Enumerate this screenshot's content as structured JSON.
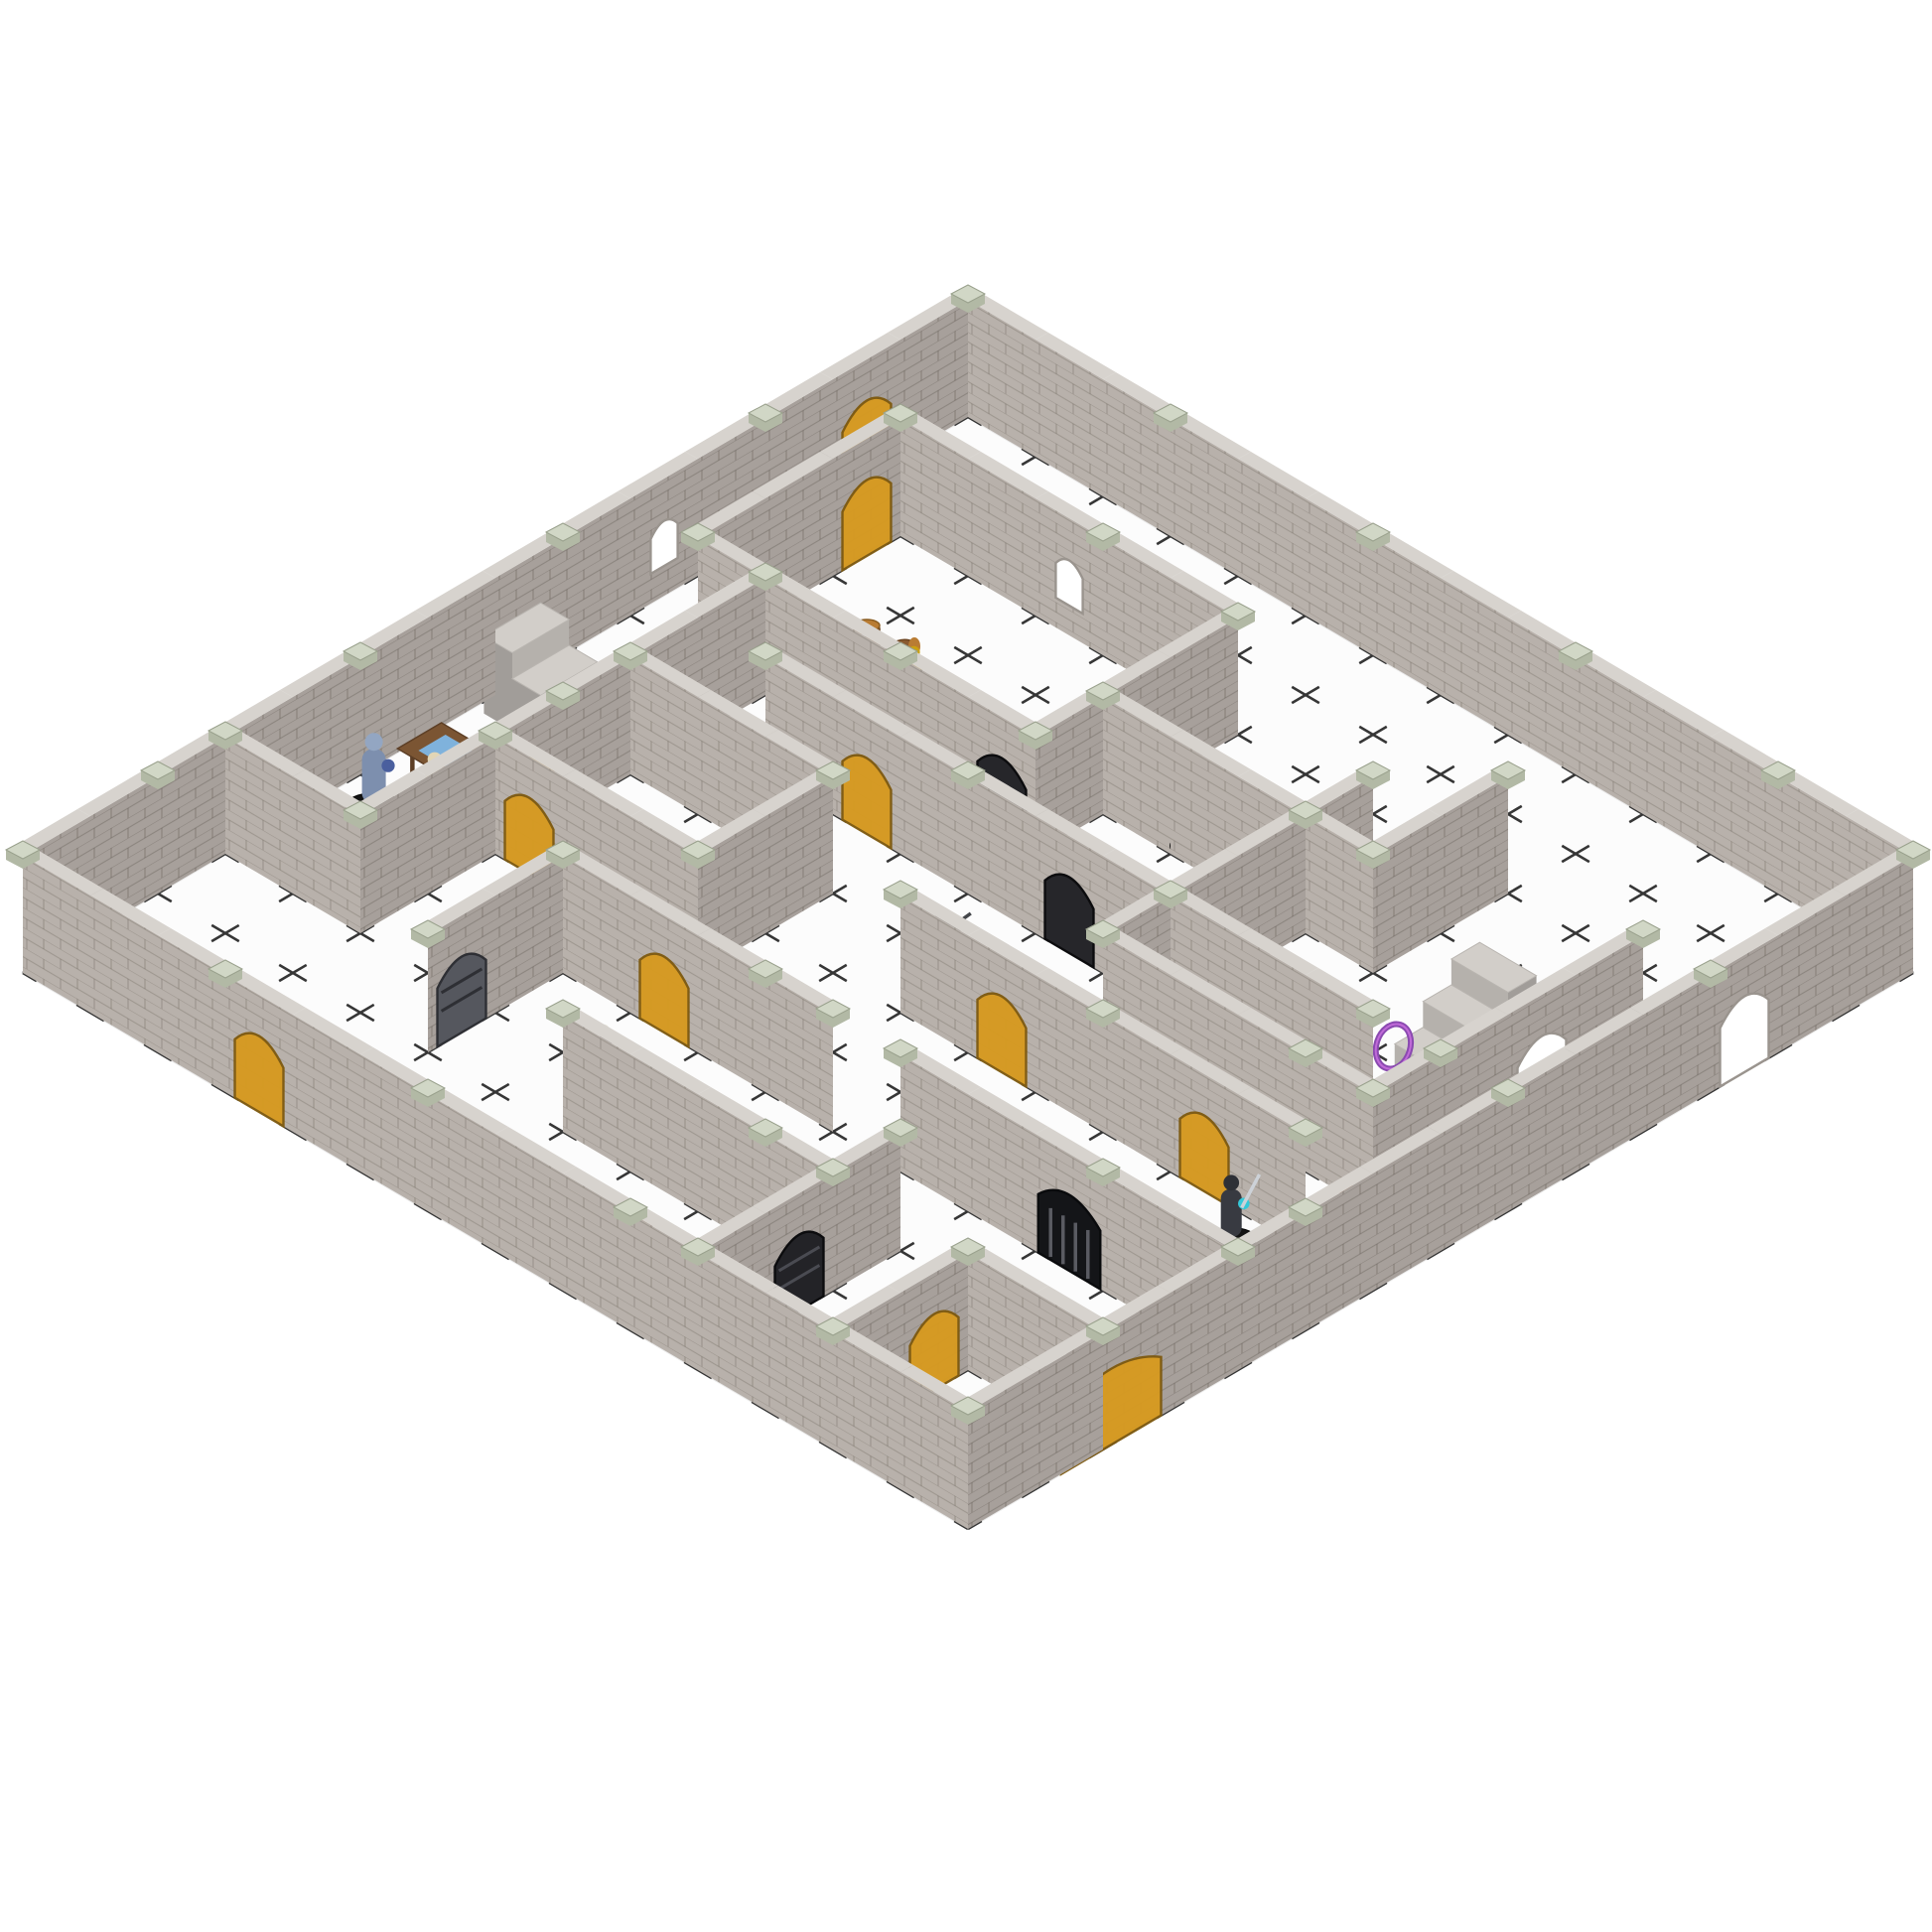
{
  "scene": {
    "type": "product-photo",
    "subject": "Modular snap-together plastic dungeon terrain set (gray brick wall panels with sage-green connector clips) assembled as a multi-room maze on a white dry-erase grid mat, populated with painted fantasy RPG miniatures, translucent amber doors, black iron doors, portcullis gates, staircases, barrels, tables and treasure",
    "background_color": "#ffffff"
  },
  "palette": {
    "background": "#ffffff",
    "floor": "#fcfcfc",
    "floor_edge": "#ececec",
    "grid": "#1b1b1b",
    "wall_sw": "#b8b1ab",
    "wall_se": "#a7a09b",
    "wall_top": "#d7d3ce",
    "mortar": "#5f584e",
    "cap_top": "#d1d7c6",
    "cap_side": "#b2b9a5",
    "door_amber": "#d79a20",
    "door_amber_edge": "#7e5a10",
    "door_black": "#26262a",
    "door_gray": "#55575e",
    "door_smoke": "#3c3c40",
    "gate": "#141518",
    "gate_bar": "#5a5b62",
    "opening": "#ffffff",
    "opening_edge": "#9a948e",
    "mini_base": "#141414",
    "stair_top": "#d2cec9",
    "stair_front": "#b5b1ac",
    "stair_side": "#a19d99",
    "wood": "#7b5533",
    "wood_dark": "#5d3f26",
    "map_blue": "#7fb2dc",
    "barrel": "#8a5a30",
    "barrel_lid": "#b97c33",
    "gold": "#d8a820",
    "gold_light": "#f0c840",
    "ring_purple": "#8a4ab0",
    "book_red": "#e2481a",
    "book_blue": "#7fa8d0"
  },
  "board": {
    "cols": 14,
    "rows": 14,
    "origin": [
      975,
      420
    ],
    "tileA": [
      68,
      40
    ],
    "tileB": [
      -68,
      40
    ],
    "wall_height": 118,
    "door_height": 84,
    "grid_dash": "16 46.9 16 0",
    "grid_stroke_width": 2.6
  },
  "walls": [
    {
      "i": 0,
      "j": 0,
      "dir": "A",
      "len": 14,
      "f": []
    },
    {
      "i": 0,
      "j": 0,
      "dir": "B",
      "len": 14,
      "f": [
        {
          "t": 1,
          "type": "amber"
        },
        {
          "t": 4,
          "type": "window"
        }
      ]
    },
    {
      "i": 0,
      "j": 14,
      "dir": "A",
      "len": 14,
      "f": [
        {
          "t": 3,
          "type": "amber"
        }
      ]
    },
    {
      "i": 14,
      "j": 0,
      "dir": "B",
      "len": 14,
      "f": [
        {
          "t": 2,
          "type": "arch"
        },
        {
          "t": 11,
          "type": "amber2"
        }
      ]
    },
    {
      "i": 1,
      "j": 2,
      "dir": "A",
      "len": 5,
      "f": [
        {
          "t": 2,
          "type": "window"
        }
      ]
    },
    {
      "i": 1,
      "j": 5,
      "dir": "A",
      "len": 5,
      "f": [
        {
          "t": 4,
          "type": "black"
        }
      ]
    },
    {
      "i": 1,
      "j": 2,
      "dir": "B",
      "len": 3,
      "f": [
        {
          "t": 0,
          "type": "amber"
        }
      ]
    },
    {
      "i": 6,
      "j": 2,
      "dir": "B",
      "len": 3,
      "f": []
    },
    {
      "i": 2,
      "j": 5,
      "dir": "B",
      "len": 6,
      "f": [
        {
          "t": 3,
          "type": "amber"
        }
      ]
    },
    {
      "i": 0,
      "j": 11,
      "dir": "A",
      "len": 2,
      "f": []
    },
    {
      "i": 2,
      "j": 7,
      "dir": "A",
      "len": 3,
      "f": []
    },
    {
      "i": 2,
      "j": 9,
      "dir": "A",
      "len": 3,
      "f": [
        {
          "t": 0,
          "type": "amber"
        }
      ]
    },
    {
      "i": 5,
      "j": 7,
      "dir": "B",
      "len": 2,
      "f": []
    },
    {
      "i": 3,
      "j": 6,
      "dir": "A",
      "len": 9,
      "f": [
        {
          "t": 1,
          "type": "amber"
        },
        {
          "t": 4,
          "type": "black"
        }
      ]
    },
    {
      "i": 6,
      "j": 4,
      "dir": "A",
      "len": 4,
      "f": []
    },
    {
      "i": 10,
      "j": 2,
      "dir": "B",
      "len": 2,
      "f": []
    },
    {
      "i": 9,
      "j": 3,
      "dir": "B",
      "len": 4,
      "f": [
        {
          "t": 2,
          "type": "smoke"
        }
      ]
    },
    {
      "i": 9,
      "j": 7,
      "dir": "A",
      "len": 4,
      "f": []
    },
    {
      "i": 13,
      "j": 3,
      "dir": "B",
      "len": 4,
      "f": [
        {
          "t": 1,
          "type": "arch"
        }
      ]
    },
    {
      "i": 7,
      "j": 8,
      "dir": "A",
      "len": 6,
      "f": [
        {
          "t": 1,
          "type": "amber"
        },
        {
          "t": 4,
          "type": "amber"
        }
      ]
    },
    {
      "i": 9,
      "j": 10,
      "dir": "A",
      "len": 5,
      "f": [
        {
          "t": 2,
          "type": "gate"
        }
      ]
    },
    {
      "i": 4,
      "j": 10,
      "dir": "A",
      "len": 4,
      "f": [
        {
          "t": 1,
          "type": "amber"
        }
      ]
    },
    {
      "i": 4,
      "j": 10,
      "dir": "B",
      "len": 2,
      "f": [
        {
          "t": 1,
          "type": "gray"
        }
      ]
    },
    {
      "i": 6,
      "j": 12,
      "dir": "A",
      "len": 4,
      "f": []
    },
    {
      "i": 10,
      "j": 11,
      "dir": "B",
      "len": 3,
      "f": [
        {
          "t": 1,
          "type": "blackbar"
        }
      ]
    },
    {
      "i": 12,
      "j": 12,
      "dir": "A",
      "len": 2,
      "f": [
        {
          "t": 1,
          "type": "arch"
        }
      ]
    },
    {
      "i": 12,
      "j": 12,
      "dir": "B",
      "len": 2,
      "f": [
        {
          "t": 0,
          "type": "amber"
        }
      ]
    }
  ],
  "props": [
    {
      "name": "staircase-left",
      "pos": [
        0.15,
        6.4
      ],
      "dir": "A"
    },
    {
      "name": "staircase-right",
      "pos": [
        11.3,
        3.8
      ],
      "dir": "B"
    },
    {
      "name": "map-table",
      "pos": [
        0.3,
        8.1
      ]
    },
    {
      "name": "barrels",
      "pos": [
        2.3,
        3.8
      ]
    },
    {
      "name": "round-table-books",
      "pos": [
        7.9,
        13.0
      ]
    },
    {
      "name": "treasure-pile",
      "pos": [
        10.6,
        5.9
      ]
    },
    {
      "name": "magic-ring",
      "pos": [
        11.35,
        5.05
      ]
    }
  ],
  "miniatures": [
    {
      "name": "frost-armored-warrior",
      "kind": "biped",
      "pos": [
        0.5,
        9.3
      ],
      "scale": 1.2,
      "body": "#7d8fae",
      "head": "#93a6c2",
      "accent": "#4a5f9e"
    },
    {
      "name": "skeleton",
      "kind": "biped",
      "pos": [
        1.0,
        8.9
      ],
      "scale": 0.95,
      "body": "#d7c9a4",
      "head": "#e2d6b6"
    },
    {
      "name": "blue-crystal",
      "kind": "gem",
      "pos": [
        0.8,
        9.9
      ],
      "scale": 1,
      "body": "#2b7bd6"
    },
    {
      "name": "warthog",
      "kind": "beast",
      "pos": [
        2.8,
        8.0
      ],
      "scale": 0.95,
      "body": "#4c3b33",
      "head": "#8a2a22"
    },
    {
      "name": "yellow-adventurer",
      "kind": "biped",
      "pos": [
        3.1,
        3.9
      ],
      "scale": 0.8,
      "body": "#e6b312",
      "head": "#caa110"
    },
    {
      "name": "elder-gnome",
      "kind": "biped",
      "pos": [
        5.6,
        11.0
      ],
      "scale": 0.85,
      "body": "#3b3b42",
      "head": "#e8e4da"
    },
    {
      "name": "black-wolf",
      "kind": "beast",
      "pos": [
        6.4,
        6.8
      ],
      "scale": 1,
      "body": "#44464a",
      "head": "#3a3c40"
    },
    {
      "name": "minotaur-raider",
      "kind": "biped",
      "pos": [
        7.1,
        3.7
      ],
      "scale": 1.15,
      "body": "#7b4b27",
      "head": "#5f3a1e",
      "accent": "#9aa2aa",
      "weapon": "#b9bec6"
    },
    {
      "name": "tan-ghoul",
      "kind": "biped",
      "pos": [
        9.4,
        9.6
      ],
      "scale": 1.25,
      "body": "#c9a875",
      "head": "#b5935f"
    },
    {
      "name": "green-sorceress",
      "kind": "biped",
      "pos": [
        10.6,
        5.4
      ],
      "scale": 1,
      "body": "#63c446",
      "head": "#dfe6e2",
      "accent": "#f08018"
    },
    {
      "name": "dark-knight",
      "kind": "biped",
      "pos": [
        12.3,
        8.4
      ],
      "scale": 1.05,
      "body": "#383a41",
      "head": "#2e3036",
      "accent": "#35c8d8",
      "weapon": "#cdd2d8"
    },
    {
      "name": "orange-demon",
      "kind": "biped",
      "pos": [
        13.2,
        7.6
      ],
      "scale": 1,
      "body": "#b5602a",
      "head": "#8e4a1e",
      "accent": "#d98a30"
    },
    {
      "name": "shield-warrior",
      "kind": "biped",
      "pos": [
        13.4,
        10.0
      ],
      "scale": 1,
      "body": "#566044",
      "head": "#6a6456",
      "accent": "#76b82a",
      "weapon": "#26262a"
    },
    {
      "name": "purple-dragon",
      "kind": "dragon",
      "pos": [
        11.1,
        12.8
      ],
      "scale": 1.1,
      "body": "#b44fc4",
      "head": "#a344b4",
      "accent": "#e0c030"
    },
    {
      "name": "bronze-dwarf-torchbearer",
      "kind": "biped",
      "pos": [
        13.1,
        13.5
      ],
      "scale": 0.95,
      "body": "#9c6d3a",
      "head": "#8a5f30",
      "accent": "#f2c812"
    }
  ],
  "inventory": {
    "wall_segments": 27,
    "amber_translucent_doors": 11,
    "black_doors": 2,
    "iron_barred_doors": 2,
    "smoked_dark_doors": 1,
    "portcullis_gates": 1,
    "open_archways": 3,
    "arch_windows": 2,
    "staircases": 2,
    "miniatures": 15,
    "props": 7
  }
}
